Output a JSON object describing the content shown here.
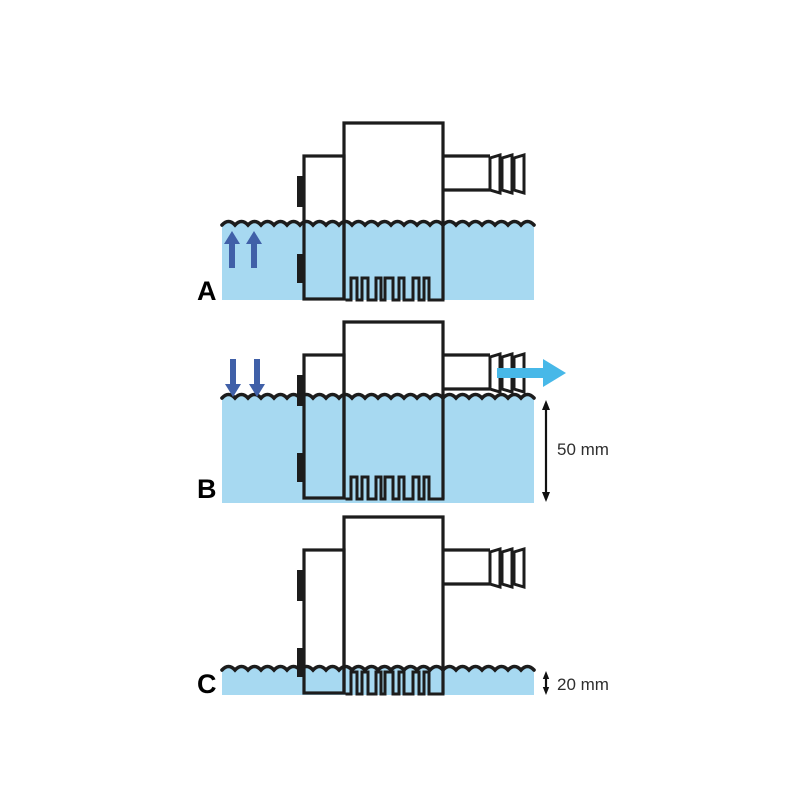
{
  "diagram": {
    "panels": [
      {
        "label": "A"
      },
      {
        "label": "B",
        "depth_label": "50 mm"
      },
      {
        "label": "C",
        "depth_label": "20 mm"
      }
    ],
    "colors": {
      "water": "#A7D9F1",
      "outline": "#1C1C1C",
      "flow_arrow": "#4060A8",
      "outflow_arrow": "#47B8E8",
      "dimension_text": "#2E2E2E"
    }
  }
}
